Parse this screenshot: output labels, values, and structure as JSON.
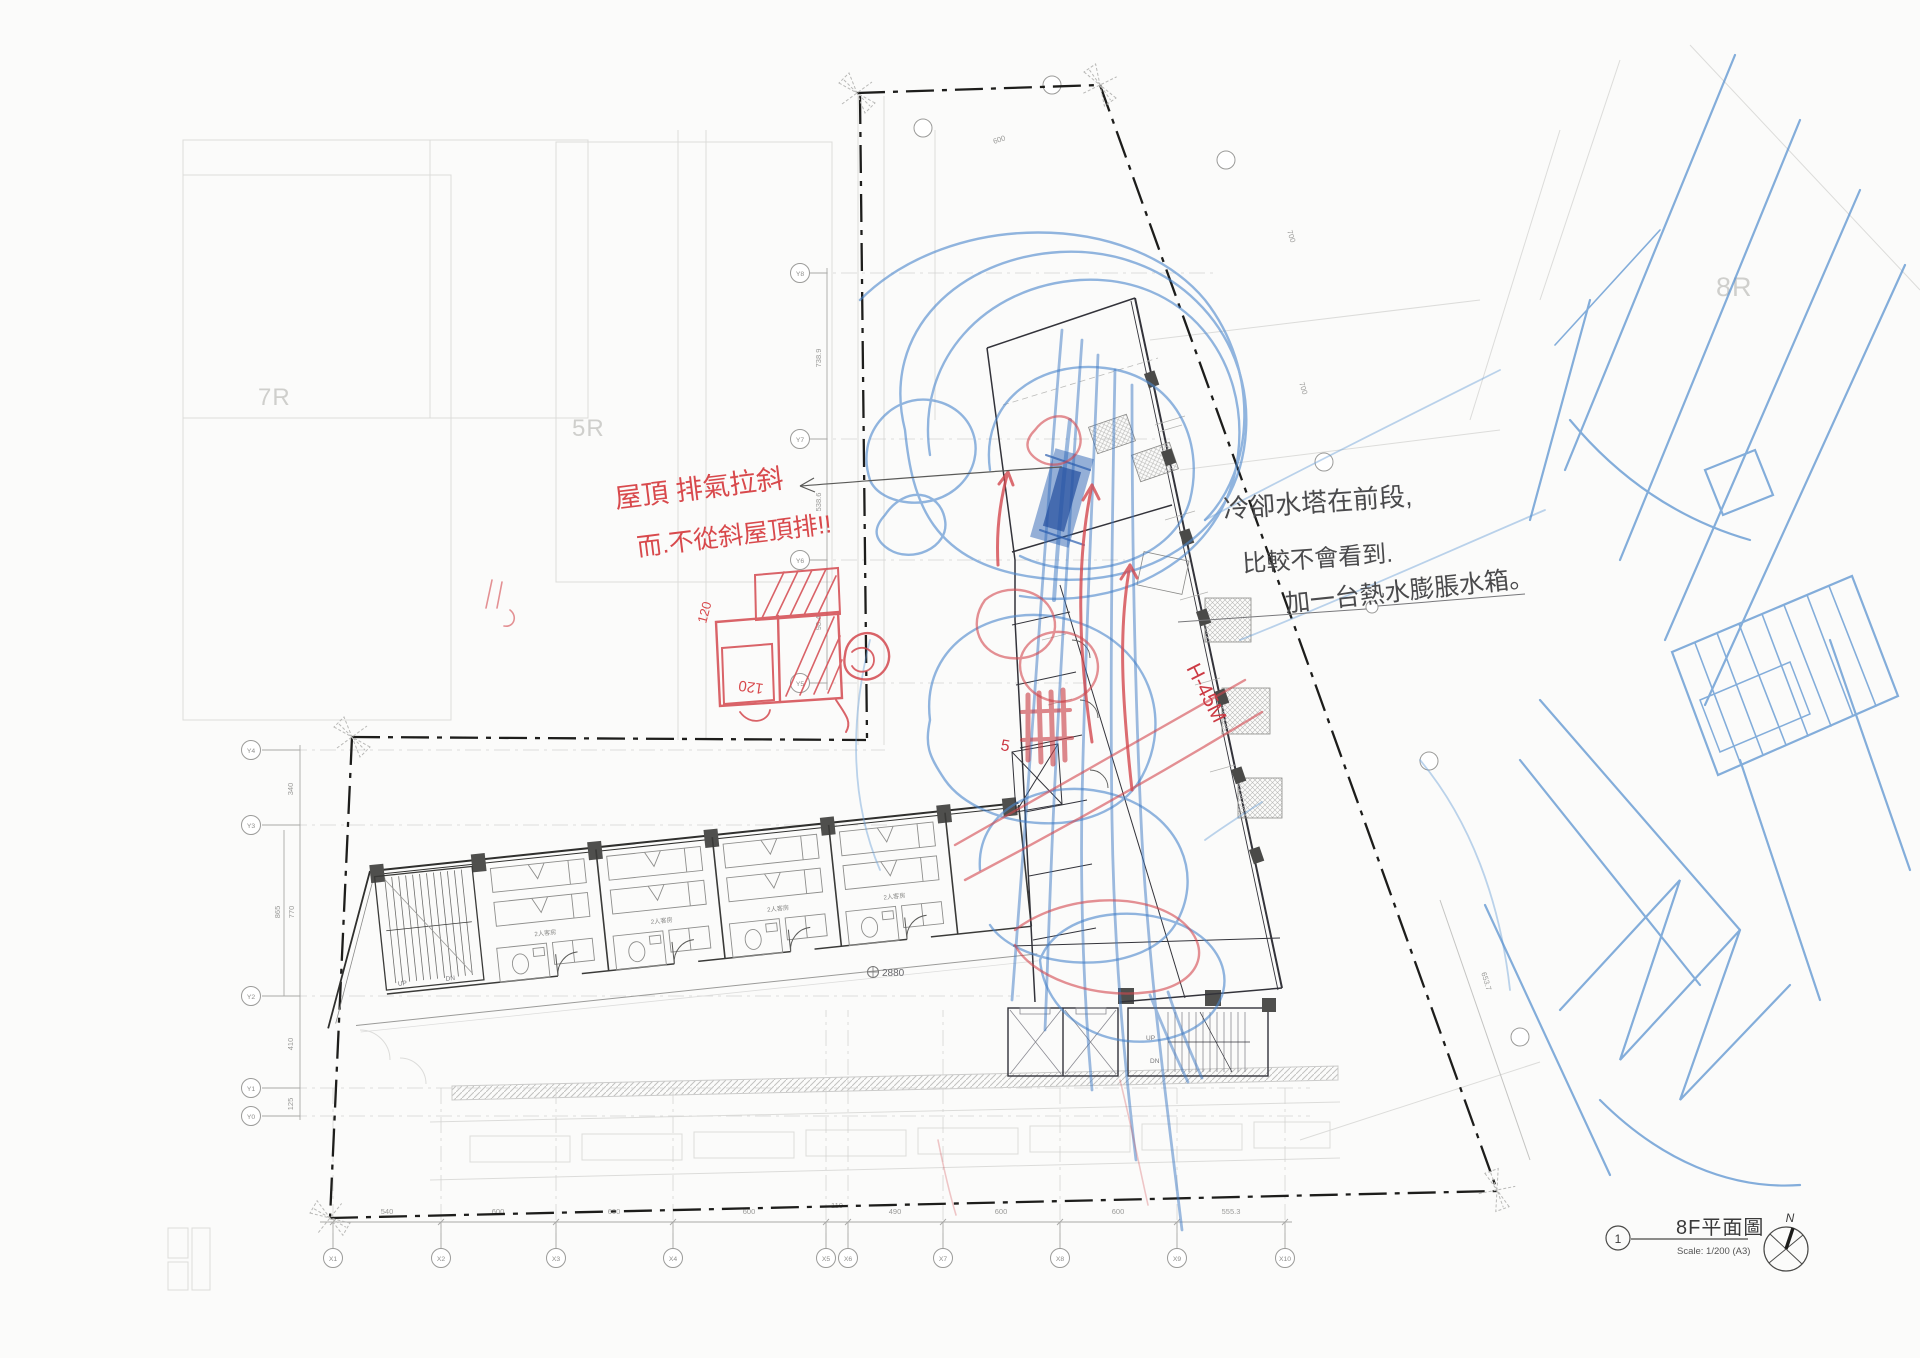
{
  "title_block": {
    "sheet_number": "1",
    "title": "8F平面圖",
    "scale": "Scale: 1/200 (A3)",
    "north_label": "N"
  },
  "background_labels": {
    "block_7r": "7R",
    "block_5r": "5R",
    "block_8r": "8R"
  },
  "grid": {
    "x_axis": {
      "bubbles": [
        "X1",
        "X2",
        "X3",
        "X4",
        "X5",
        "X6",
        "X7",
        "X8",
        "X9",
        "X10"
      ],
      "dimensions": [
        "540",
        "600",
        "600",
        "600",
        "110",
        "490",
        "600",
        "600",
        "555.3"
      ]
    },
    "y_axis_lower": {
      "bubbles": [
        "Y0",
        "Y1",
        "Y2",
        "Y3",
        "Y4"
      ],
      "dimensions": [
        "125",
        "410",
        "865",
        "770",
        "340"
      ]
    },
    "y_axis_upper": {
      "bubbles": [
        "Y5",
        "Y6",
        "Y7",
        "Y8"
      ],
      "dimensions": [
        "98.4",
        "538.6",
        "738.9"
      ]
    },
    "misc_dimensions": [
      "600",
      "700",
      "700",
      "653.7"
    ]
  },
  "plan": {
    "room_label": "2人客房",
    "stair_up": "UP",
    "stair_down": "DN",
    "level_mark": "2880"
  },
  "annotations": {
    "red_note_line1": "屋頂 排氣拉斜",
    "red_note_line2": "而.不從斜屋頂排!!",
    "black_note_line1": "冷卻水塔在前段,",
    "black_note_line2": "比較不會看到.",
    "black_note_line3": "加一台熱水膨脹水箱。",
    "red_dim_a": "120",
    "red_dim_b": "120",
    "red_height_note": "H-45M",
    "red_number": "5"
  },
  "colors": {
    "blue_pen": "#3e79c4",
    "blue_dark": "#2a5cae",
    "red_pen": "#d4494f",
    "line_dark": "#2e2e2e",
    "line_faint": "#cfcfcd"
  }
}
